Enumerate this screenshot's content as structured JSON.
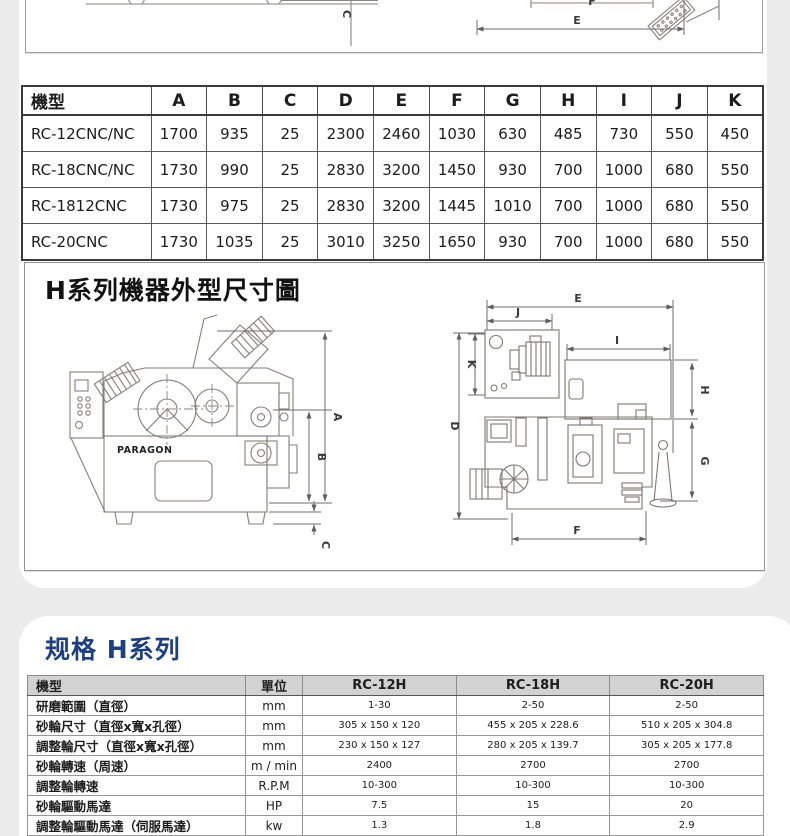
{
  "top_drawing": {
    "label_c": "C",
    "label_e": "E",
    "label_f": "F"
  },
  "dim_table": {
    "headers": [
      "機型",
      "A",
      "B",
      "C",
      "D",
      "E",
      "F",
      "G",
      "H",
      "I",
      "J",
      "K"
    ],
    "rows": [
      [
        "RC-12CNC/NC",
        "1700",
        "935",
        "25",
        "2300",
        "2460",
        "1030",
        "630",
        "485",
        "730",
        "550",
        "450"
      ],
      [
        "RC-18CNC/NC",
        "1730",
        "990",
        "25",
        "2830",
        "3200",
        "1450",
        "930",
        "700",
        "1000",
        "680",
        "550"
      ],
      [
        "RC-1812CNC",
        "1730",
        "975",
        "25",
        "2830",
        "3200",
        "1445",
        "1010",
        "700",
        "1000",
        "680",
        "550"
      ],
      [
        "RC-20CNC",
        "1730",
        "1035",
        "25",
        "3010",
        "3250",
        "1650",
        "930",
        "700",
        "1000",
        "680",
        "550"
      ]
    ]
  },
  "diagram": {
    "title": "H系列機器外型尺寸圖",
    "brand": "PARAGON",
    "front_labels": {
      "a": "A",
      "b": "B",
      "c": "C"
    },
    "top_labels": {
      "d": "D",
      "e": "E",
      "f": "F",
      "g": "G",
      "h": "H",
      "i": "I",
      "j": "J",
      "k": "K"
    }
  },
  "spec": {
    "title": "规格 H系列",
    "headers": [
      "機型",
      "單位",
      "RC-12H",
      "RC-18H",
      "RC-20H"
    ],
    "rows": [
      [
        "研磨範圍（直徑）",
        "mm",
        "1-30",
        "2-50",
        "2-50"
      ],
      [
        "砂輪尺寸（直徑x寬x孔徑）",
        "mm",
        "305 x 150 x 120",
        "455 x 205 x 228.6",
        "510 x 205 x 304.8"
      ],
      [
        "調整輪尺寸（直徑x寬x孔徑）",
        "mm",
        "230 x 150 x 127",
        "280 x 205 x 139.7",
        "305 x 205 x 177.8"
      ],
      [
        "砂輪轉速（周速）",
        "m / min",
        "2400",
        "2700",
        "2700"
      ],
      [
        "調整輪轉速",
        "R.P.M",
        "10-300",
        "10-300",
        "10-300"
      ],
      [
        "砂輪驅動馬達",
        "HP",
        "7.5",
        "15",
        "20"
      ],
      [
        "調整輪驅動馬達（伺服馬達）",
        "kw",
        "1.3",
        "1.8",
        "2.9"
      ]
    ]
  },
  "colors": {
    "accent_blue": "#1e4080",
    "header_gray": "#d2d2d2",
    "page_bg": "#ececec"
  }
}
